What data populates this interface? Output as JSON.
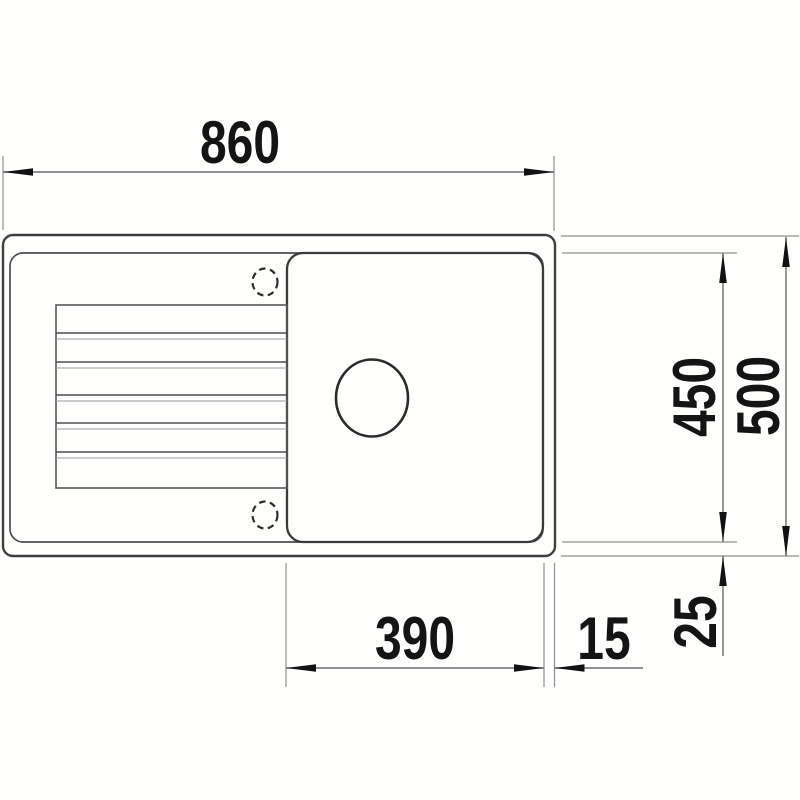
{
  "drawing": {
    "kind": "sink-technical-drawing-top-view",
    "unit": "mm",
    "dims": {
      "overall_width": "860",
      "overall_depth": "500",
      "bowl_depth": "450",
      "bowl_width": "390",
      "right_rim": "15",
      "bottom_rim": "25"
    },
    "colors": {
      "background": "#fffffe",
      "main_line": "#3e3e3e",
      "light_line": "#8f8f8f",
      "text_and_arrows": "#141414"
    }
  }
}
